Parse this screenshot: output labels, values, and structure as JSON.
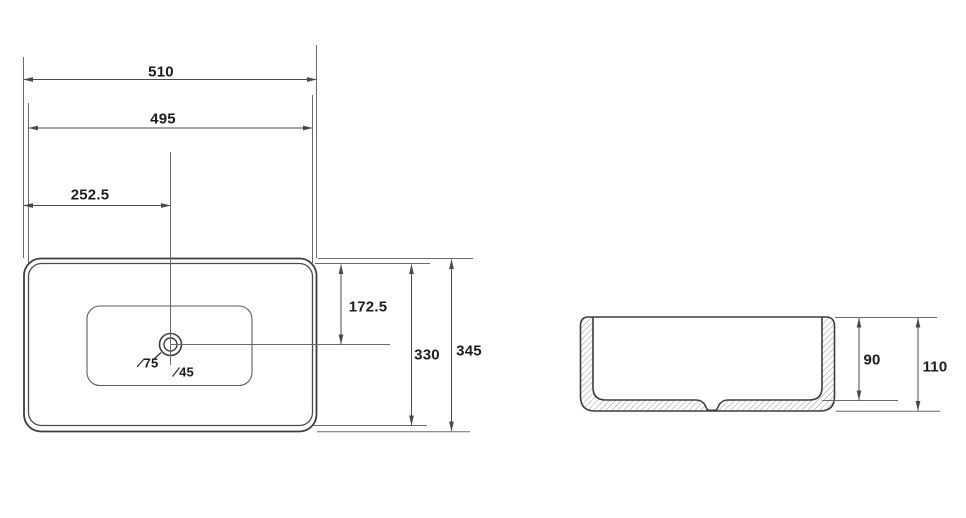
{
  "drawing": {
    "colors": {
      "outline": "#3d3d3d",
      "dimension_line": "#4a4a4a",
      "extension_line": "#6a6a6a",
      "hatch": "#969696",
      "text": "#1c1c1c",
      "background": "#ffffff"
    },
    "top_view": {
      "overall_width": "510",
      "inner_width": "495",
      "drain_center_from_left": "252.5",
      "drain_center_from_top": "172.5",
      "inner_depth": "330",
      "overall_depth": "345",
      "drain_outer_diameter": "75",
      "drain_inner_diameter": "45"
    },
    "side_view": {
      "inner_height": "90",
      "overall_height": "110"
    }
  }
}
